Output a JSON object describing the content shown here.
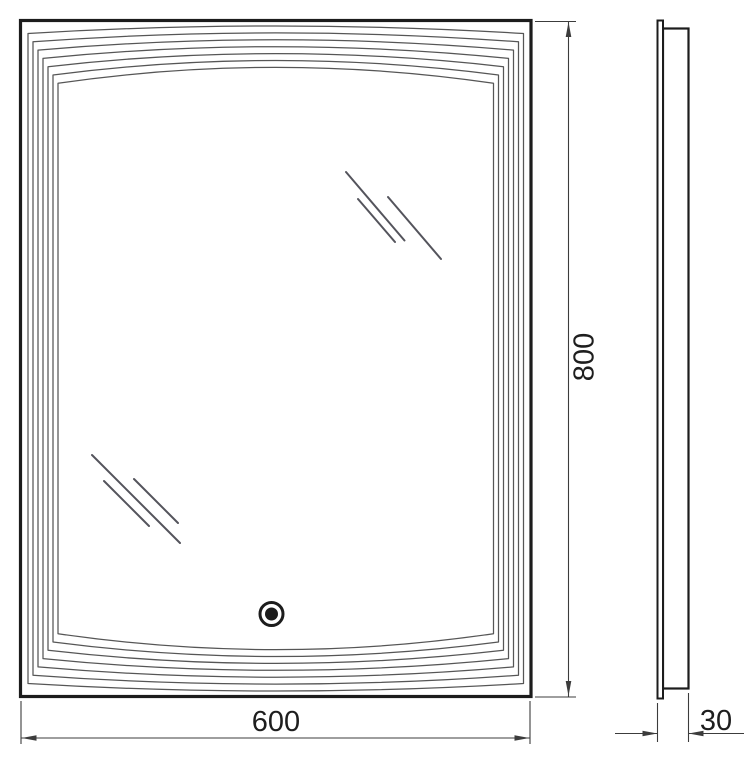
{
  "drawing": {
    "name": "illuminated-mirror-dimension-drawing",
    "views": {
      "front": "front-view",
      "side": "side-profile-view"
    }
  },
  "dimensions": {
    "width": {
      "value": "600"
    },
    "height": {
      "value": "800"
    },
    "depth": {
      "value": "30"
    }
  },
  "icons": {
    "touch_sensor": "touch-sensor-icon",
    "glass_shine": "glass-shine-lines"
  },
  "colors": {
    "background": "#ffffff",
    "outline": "#1c1c1c",
    "frame_line": "#565656",
    "shine_line": "#54545c",
    "dimension_line": "#3c3c3c",
    "text": "#1e1e1e"
  }
}
